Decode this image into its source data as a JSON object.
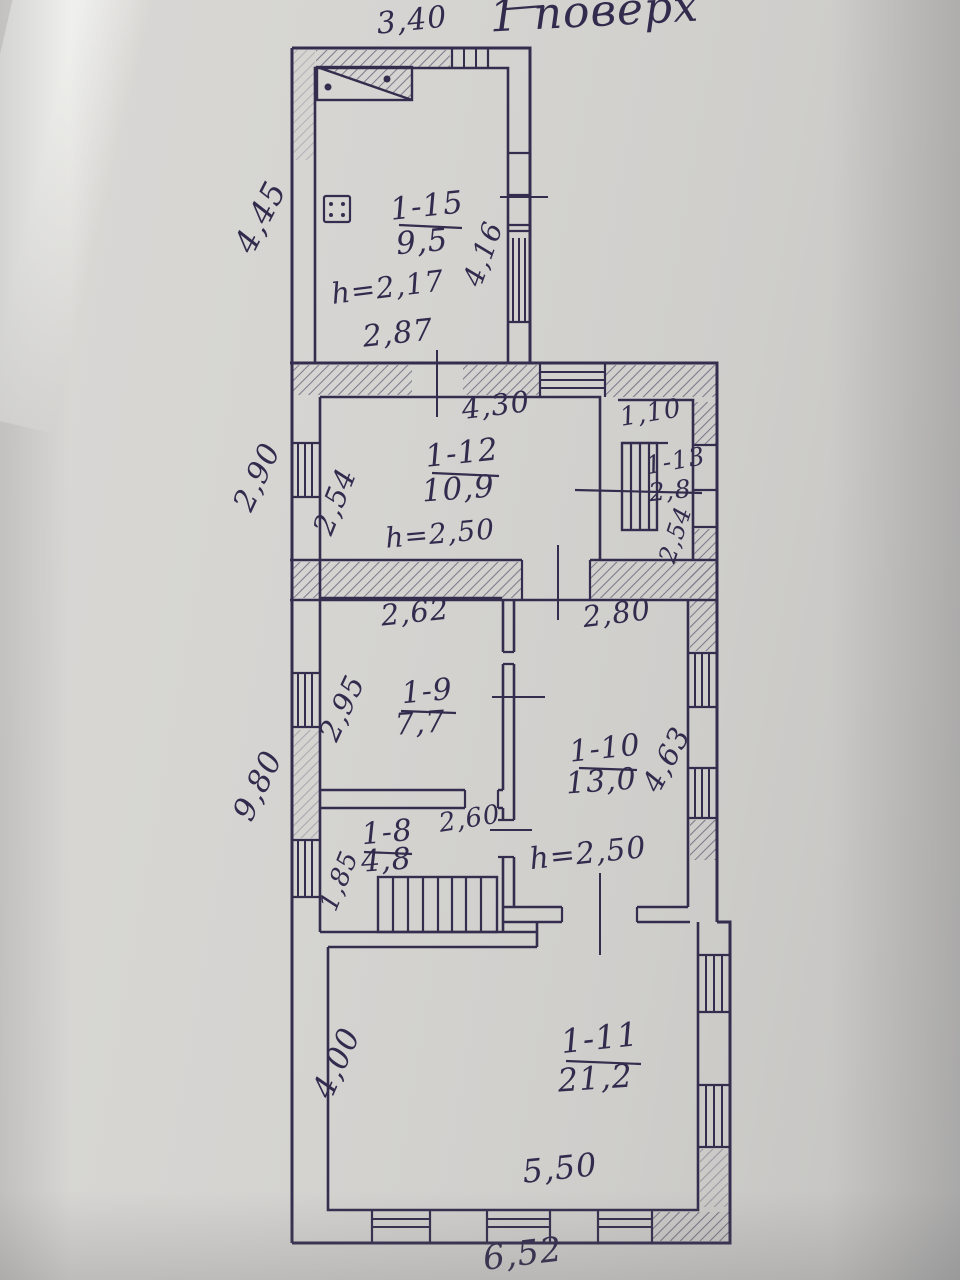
{
  "title": "1 поверх",
  "rooms": {
    "r15": {
      "id": "1-15",
      "area": "9,5"
    },
    "r12": {
      "id": "1-12",
      "area": "10,9"
    },
    "r13": {
      "id": "1-13",
      "area": "2,8"
    },
    "r9": {
      "id": "1-9",
      "area": "7,7"
    },
    "r10": {
      "id": "1-10",
      "area": "13,0"
    },
    "r8": {
      "id": "1-8",
      "area": "4,8"
    },
    "r11": {
      "id": "1-11",
      "area": "21,2"
    }
  },
  "heights": {
    "r15": "h=2,17",
    "r12": "h=2,50",
    "r10": "h=2,50"
  },
  "dims": {
    "top_width": "3,40",
    "kitchen_left": "4,45",
    "kitchen_right": "4,16",
    "kitchen_bottom": "2,87",
    "hall_top": "4,30",
    "hall_left_outer": "2,90",
    "hall_left_inner": "2,54",
    "pantry_top": "1,10",
    "pantry_right": "2,54",
    "room9_top": "2,62",
    "room9_left": "2,95",
    "room10_top": "2,80",
    "room10_right": "4,63",
    "left_lower": "9,80",
    "room8_top": "2,60",
    "room8_left": "1,85",
    "room11_left": "4,00",
    "room11_bottom_inner": "5,50",
    "bottom_outer": "6,52"
  },
  "ink_color": "#352d4e",
  "paper_color": "#d3d2cf"
}
